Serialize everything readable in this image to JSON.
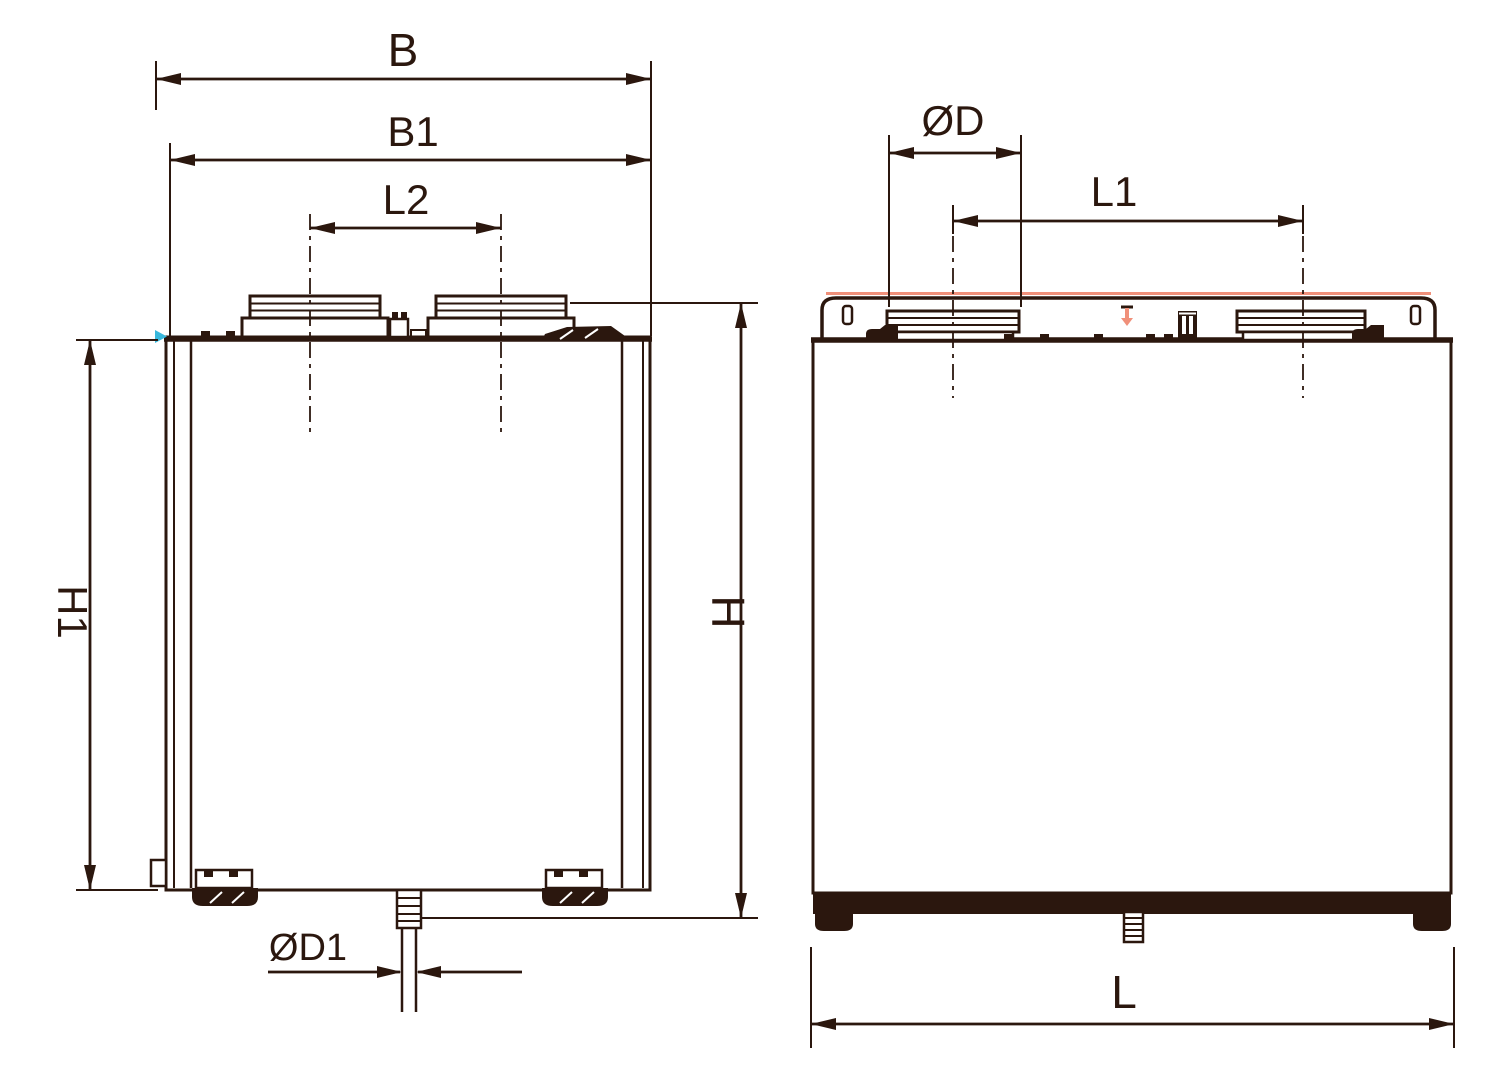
{
  "diagram": {
    "type": "technical-dimension-drawing",
    "subject": "ventilation-unit-two-views",
    "colors": {
      "line": "#2b170e",
      "accent_salmon": "#f0907a",
      "accent_cyan": "#38b8dc",
      "background": "#ffffff"
    },
    "labels": {
      "B": "B",
      "B1": "B1",
      "L2": "L2",
      "H1": "H1",
      "H": "H",
      "D1": "ØD1",
      "D": "ØD",
      "L1": "L1",
      "L": "L"
    },
    "views": {
      "front": {
        "dimension_labels": [
          "B",
          "B1",
          "L2",
          "H1",
          "H",
          "ØD1"
        ]
      },
      "side": {
        "dimension_labels": [
          "ØD",
          "L1",
          "L"
        ]
      }
    }
  }
}
